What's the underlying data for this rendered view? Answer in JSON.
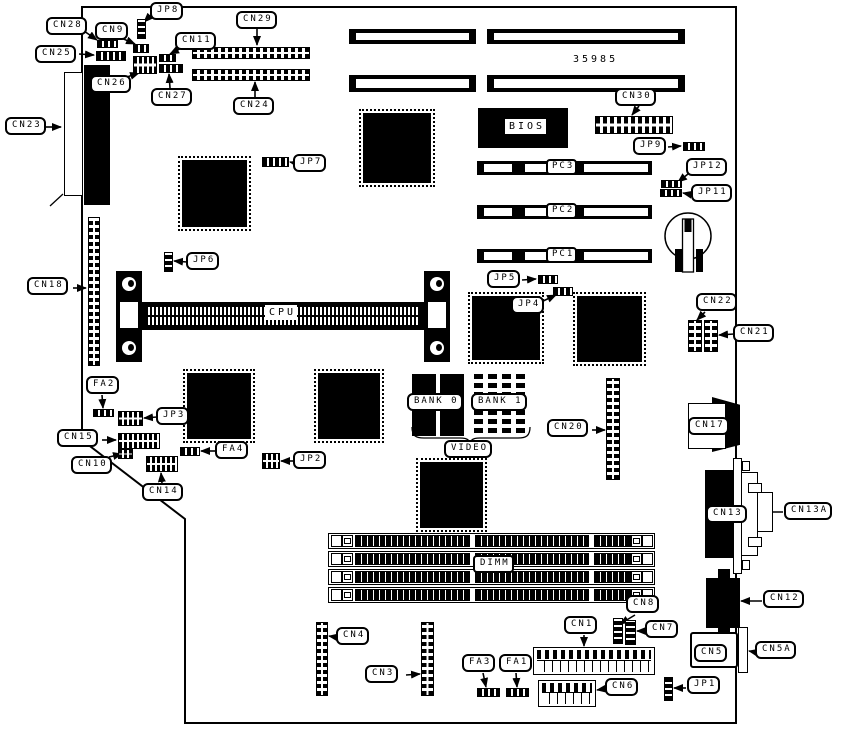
{
  "part_number": "35985",
  "labels": {
    "jp8": "JP8",
    "cn28": "CN28",
    "cn9": "CN9",
    "cn29": "CN29",
    "cn25": "CN25",
    "cn11": "CN11",
    "cn26": "CN26",
    "cn27": "CN27",
    "cn24": "CN24",
    "cn23": "CN23",
    "cn30": "CN30",
    "jp9": "JP9",
    "jp12": "JP12",
    "jp11": "JP11",
    "jp7": "JP7",
    "bios": "BIOS",
    "pc3": "PC3",
    "pc2": "PC2",
    "pc1": "PC1",
    "cn18": "CN18",
    "jp6": "JP6",
    "cpu": "CPU",
    "jp5": "JP5",
    "jp4": "JP4",
    "cn22": "CN22",
    "cn21": "CN21",
    "fa2": "FA2",
    "jp3": "JP3",
    "cn15": "CN15",
    "cn10": "CN10",
    "cn14": "CN14",
    "fa4": "FA4",
    "jp2": "JP2",
    "bank0": "BANK 0",
    "bank1": "BANK 1",
    "video": "VIDEO",
    "cn20": "CN20",
    "cn17": "CN17",
    "cn13": "CN13",
    "cn13a": "CN13A",
    "cn12": "CN12",
    "dimm": "DIMM",
    "cn8": "CN8",
    "cn1": "CN1",
    "cn7": "CN7",
    "cn5": "CN5",
    "cn5a": "CN5A",
    "cn4": "CN4",
    "cn3": "CN3",
    "fa3": "FA3",
    "fa1": "FA1",
    "cn6": "CN6",
    "jp1": "JP1"
  }
}
